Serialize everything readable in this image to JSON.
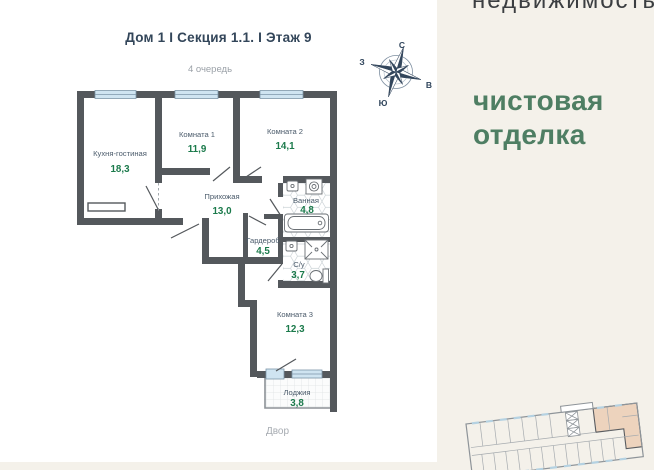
{
  "header": {
    "title": "Дом 1 I Секция 1.1. I Этаж 9",
    "queue": "4 очередь"
  },
  "compass": {
    "n": "С",
    "s": "Ю",
    "w": "З",
    "e": "В"
  },
  "plan": {
    "yard_label": "Двор",
    "rooms": [
      {
        "name": "Кухня-гостиная",
        "area": "18,3"
      },
      {
        "name": "Комната 1",
        "area": "11,9"
      },
      {
        "name": "Комната 2",
        "area": "14,1"
      },
      {
        "name": "Прихожая",
        "area": "13,0"
      },
      {
        "name": "Ванная",
        "area": "4,8"
      },
      {
        "name": "Гардероб",
        "area": "4,5"
      },
      {
        "name": "С/у",
        "area": "3,7"
      },
      {
        "name": "Комната 3",
        "area": "12,3"
      },
      {
        "name": "Лоджия",
        "area": "3,8"
      }
    ]
  },
  "sidebar": {
    "logo_text": "недвижимость",
    "finish_line1": "чистовая",
    "finish_line2": "отделка"
  },
  "colors": {
    "wall": "#54585c",
    "window_fill": "#cfe4f1",
    "area_green": "#1b7a4b",
    "finish_green": "#4e7e63",
    "page_beige": "#f4f1ea",
    "highlight_apartment": "#edd3bd"
  }
}
